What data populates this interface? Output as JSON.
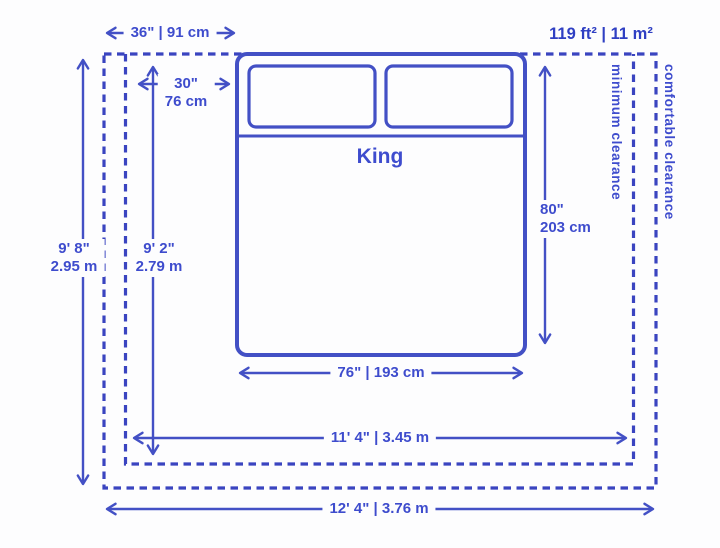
{
  "diagram_title": "King bed with minimum and comfortable room clearances",
  "colors": {
    "solid_line": "#4350c5",
    "dashed_line": "#3a44c0",
    "text": "#3e4ccd",
    "area_text": "#2f3fc3",
    "background": "#fdfdfe"
  },
  "bed": {
    "name_label": "King",
    "width_label": "76\" | 193 cm",
    "length_in": "80\"",
    "length_cm": "203 cm",
    "pillow_width_in": "30\"",
    "pillow_width_cm": "76 cm"
  },
  "room": {
    "area_label": "119 ft² | 11 m²",
    "side_clearance_label": "36\" | 91 cm",
    "comfortable_height_ft": "9' 8\"",
    "comfortable_height_m": "2.95 m",
    "minimum_height_ft": "9' 2\"",
    "minimum_height_m": "2.79 m",
    "minimum_width_label": "11' 4\" | 3.45 m",
    "comfortable_width_label": "12' 4\" | 3.76 m",
    "minimum_clearance_label": "minimum clearance",
    "comfortable_clearance_label": "comfortable clearance"
  }
}
